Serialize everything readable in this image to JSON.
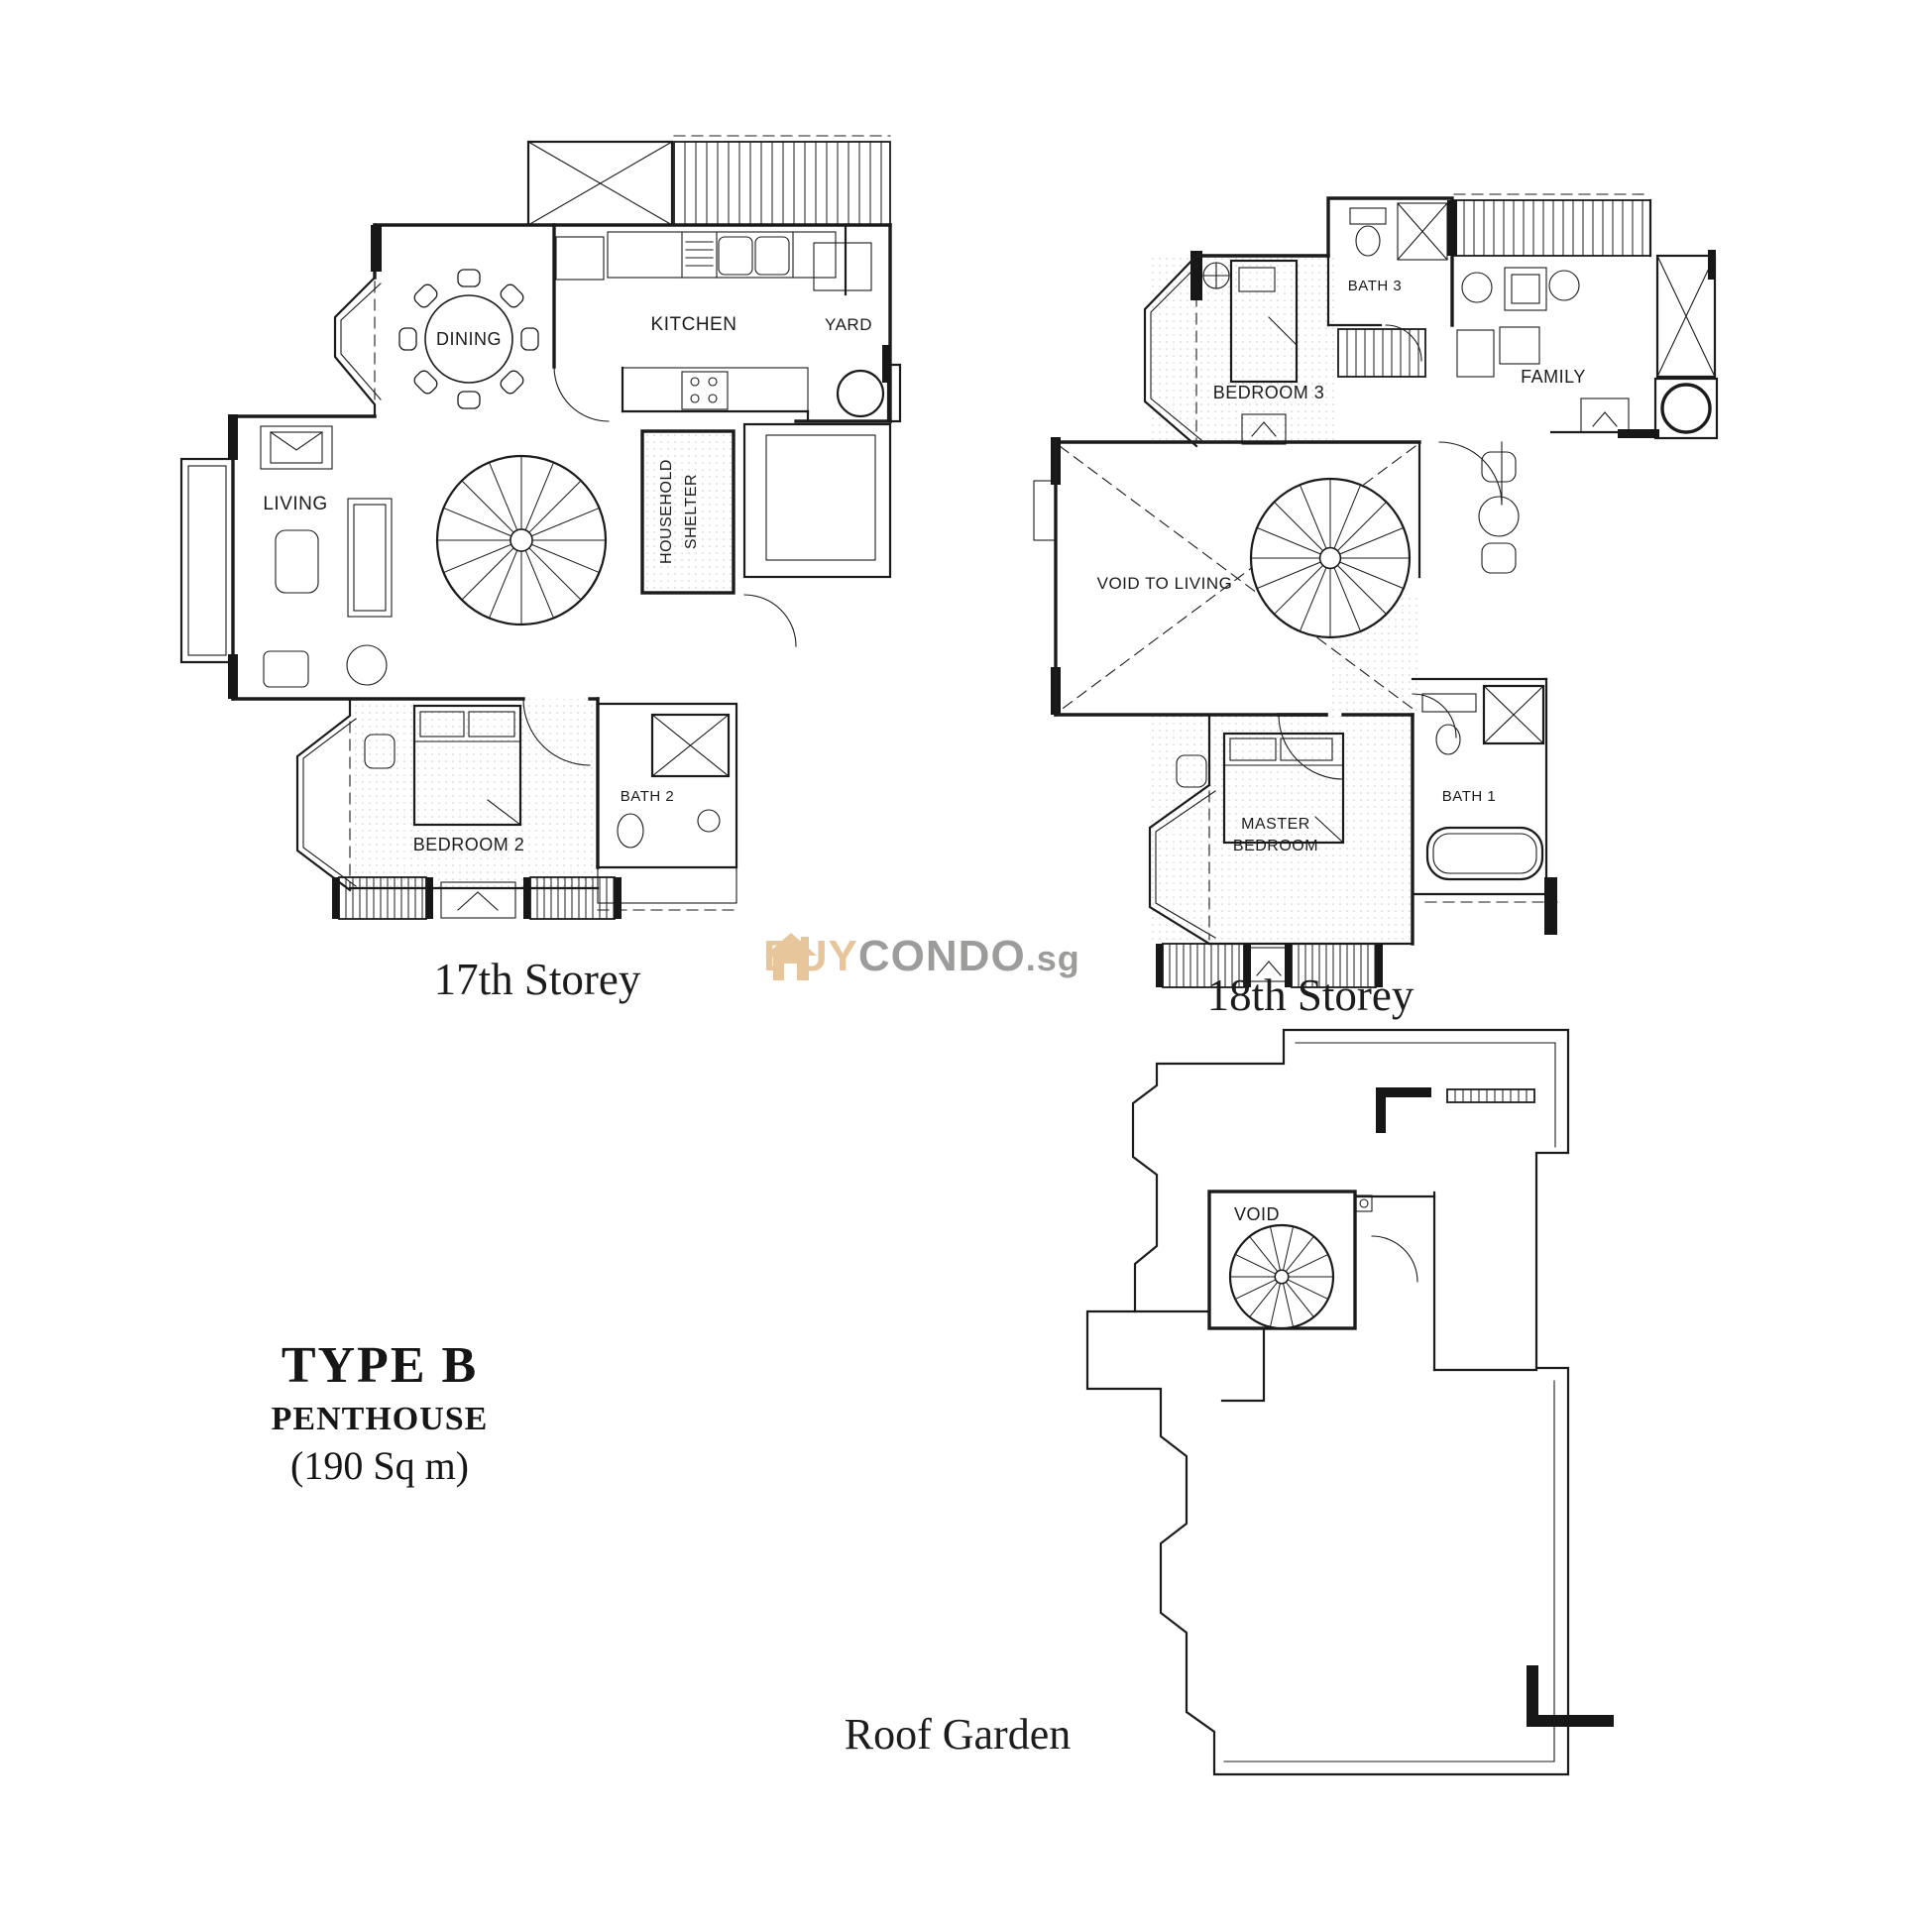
{
  "page": {
    "background": "#ffffff",
    "line_color": "#1b1b1b"
  },
  "unit_info": {
    "type": "TYPE B",
    "category": "PENTHOUSE",
    "area": "(190 Sq m)"
  },
  "watermark": {
    "brand_prefix": "BUY",
    "brand_mid": "CONDO",
    "tld": ".sg",
    "prefix_color": "#E7C69C",
    "mid_color": "#9C9C9A"
  },
  "floor17": {
    "caption": "17th Storey",
    "labels": {
      "dining": "DINING",
      "kitchen": "KITCHEN",
      "yard": "YARD",
      "living": "LIVING",
      "household_1": "HOUSEHOLD",
      "household_2": "SHELTER",
      "bath2": "BATH 2",
      "bedroom2": "BEDROOM 2"
    }
  },
  "floor18": {
    "caption": "18th Storey",
    "labels": {
      "bath3": "BATH 3",
      "bedroom3": "BEDROOM 3",
      "family": "FAMILY",
      "void": "VOID TO LIVING",
      "master_1": "MASTER",
      "master_2": "BEDROOM",
      "bath1": "BATH 1"
    }
  },
  "roof": {
    "caption": "Roof Garden",
    "labels": {
      "void": "VOID"
    }
  }
}
